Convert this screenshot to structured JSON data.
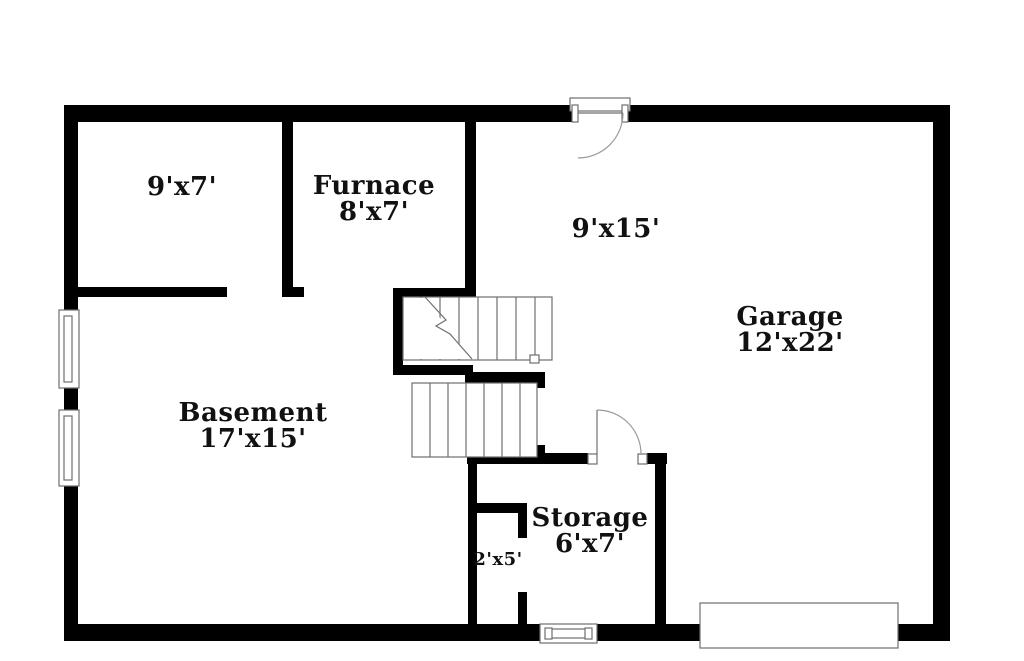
{
  "colors": {
    "wall": "#000000",
    "line": "#6f6f6f",
    "arc": "#9a9a9a",
    "background": "#ffffff",
    "text": "#111111"
  },
  "rooms": {
    "top_left": {
      "dimensions": "9'x7'"
    },
    "furnace": {
      "name": "Furnace",
      "dimensions": "8'x7'"
    },
    "hallway": {
      "dimensions": "9'x15'"
    },
    "garage": {
      "name": "Garage",
      "dimensions": "12'x22'"
    },
    "basement": {
      "name": "Basement",
      "dimensions": "17'x15'"
    },
    "storage": {
      "name": "Storage",
      "dimensions": "6'x7'"
    },
    "closet": {
      "dimensions": "2'x5'"
    }
  }
}
